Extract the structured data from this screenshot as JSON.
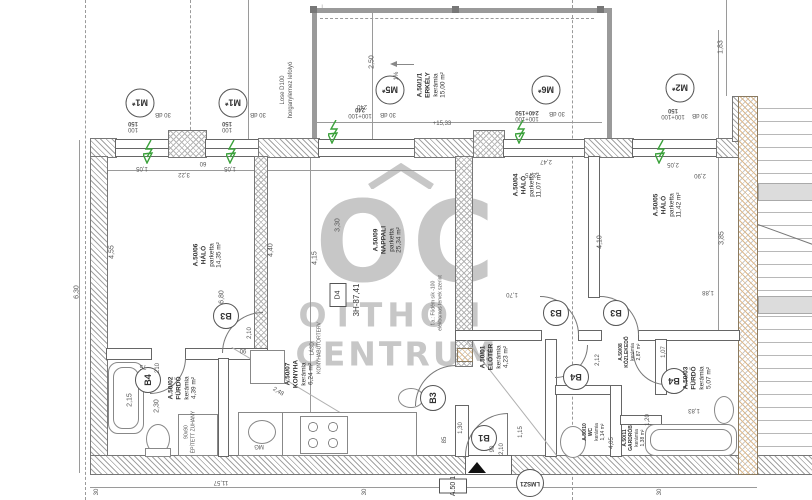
{
  "watermark": {
    "logo": "OC",
    "line1": "OTTHON",
    "line2": "CENTRUM"
  },
  "unit": {
    "box": "D4",
    "code": "3H-87,41"
  },
  "rooms": [
    {
      "id": "A.50/06",
      "name": "HÁLÓ",
      "finish": "parketta",
      "area": "14,35 m²"
    },
    {
      "id": "A.50/09",
      "name": "NAPPALI",
      "finish": "parketta",
      "area": "25,34 m²"
    },
    {
      "id": "A.50/04",
      "name": "HÁLÓ",
      "finish": "parketta",
      "area": "11,07 m²"
    },
    {
      "id": "A.50/05",
      "name": "HÁLÓ",
      "finish": "parketta",
      "area": "11,42 m²"
    },
    {
      "id": "A.50/07",
      "name": "KONYHA",
      "finish": "kerámia",
      "area": "6,24 m²"
    },
    {
      "id": "A.50/02",
      "name": "FÜRDŐ",
      "finish": "kerámia",
      "area": "4,39 m²"
    },
    {
      "id": "A.50/01",
      "name": "ELŐTÉR",
      "finish": "kerámia",
      "area": "4,23 m²"
    },
    {
      "id": "A.50/08",
      "name": "KÖZLEKEDŐ",
      "finish": "kerámia",
      "area": "2,87 m²"
    },
    {
      "id": "A.50/10",
      "name": "WC",
      "finish": "kerámia",
      "area": "1,14 m²"
    },
    {
      "id": "A.50/03",
      "name": "FÜRDŐ",
      "finish": "kerámia",
      "area": "5,07 m²"
    },
    {
      "id": "A.50/11",
      "name": "GARDRÓB",
      "finish": "kerámia",
      "area": "1,38 m²"
    },
    {
      "id": "A.50/1/1",
      "name": "ERKÉLY",
      "finish": "kerámia",
      "area": "15,00 m²"
    }
  ],
  "tags": {
    "m1": "M1*",
    "m2": "M2*",
    "m5": "M5*",
    "m6": "M6*",
    "b1": "B1",
    "b3": "B3",
    "b4": "B4",
    "lmsz": "LMSZ1",
    "entry": "A.50 1"
  },
  "window_dims": {
    "m1a": "100",
    "m1b": "150",
    "m5a": "100+100",
    "m5b": "240",
    "m6a": "100+100",
    "m6b": "240+150",
    "m2a": "100+100",
    "m2b": "150"
  },
  "notes": {
    "db": "30 dB",
    "slope": "1%",
    "level": "+15,33",
    "downpipe1": "Lose D100",
    "downpipe2": "horganylemez lefolyó",
    "mg": "MG",
    "shower_size": "90x90",
    "shower": "ÉPÍTETT ZUHANY",
    "floor1": "f.a.: Födém sík -100",
    "floor2": "elektromos tervek szerint",
    "kitchen1": "LÁSD:",
    "kitchen2": "KONYHABÚTORTERV"
  },
  "dims": [
    "4,55",
    "3,30",
    "4,15",
    "4,40",
    "6,80",
    "6,30",
    "2,50",
    "1,83",
    "2,05",
    "2,90",
    "3,85",
    "1,88",
    "1,70",
    "2,75",
    "2,47",
    "4,10",
    "2,15",
    "2,30",
    "2,48",
    "2,10",
    "90",
    "75",
    "210",
    "1,05",
    "1,05",
    "3,22",
    "60",
    "11,57",
    "30",
    "30",
    "2,12",
    "1,20",
    "1,83",
    "1,07",
    "4,05",
    "1,15",
    "85",
    "1,30",
    "90",
    "2,10",
    "240",
    "30"
  ]
}
